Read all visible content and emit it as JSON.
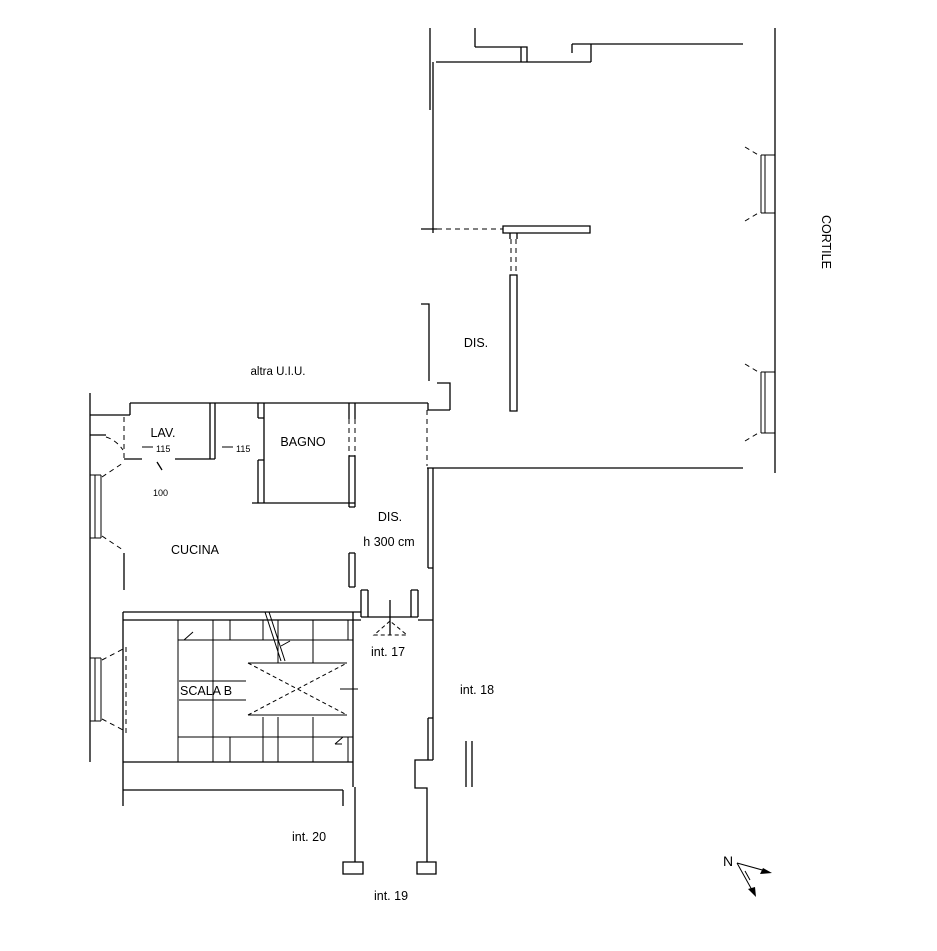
{
  "canvas": {
    "width": 937,
    "height": 951,
    "background": "#ffffff",
    "line_color": "#000000"
  },
  "plan": {
    "type": "floor-plan",
    "unit_labels": {
      "altra_uiu": "altra U.I.U.",
      "int17": "int. 17",
      "int18": "int. 18",
      "int19": "int. 19",
      "int20": "int. 20",
      "cortile": "CORTILE"
    },
    "room_labels": {
      "lav": "LAV.",
      "bagno": "BAGNO",
      "dis_upper": "DIS.",
      "dis_corridor": "DIS.",
      "dis_height": "h 300 cm",
      "cucina": "CUCINA",
      "scala": "SCALA B"
    },
    "dimension_labels": {
      "door_lav": "115",
      "door_bagno": "115",
      "width_lav": "100"
    },
    "compass": {
      "north": "N"
    }
  }
}
